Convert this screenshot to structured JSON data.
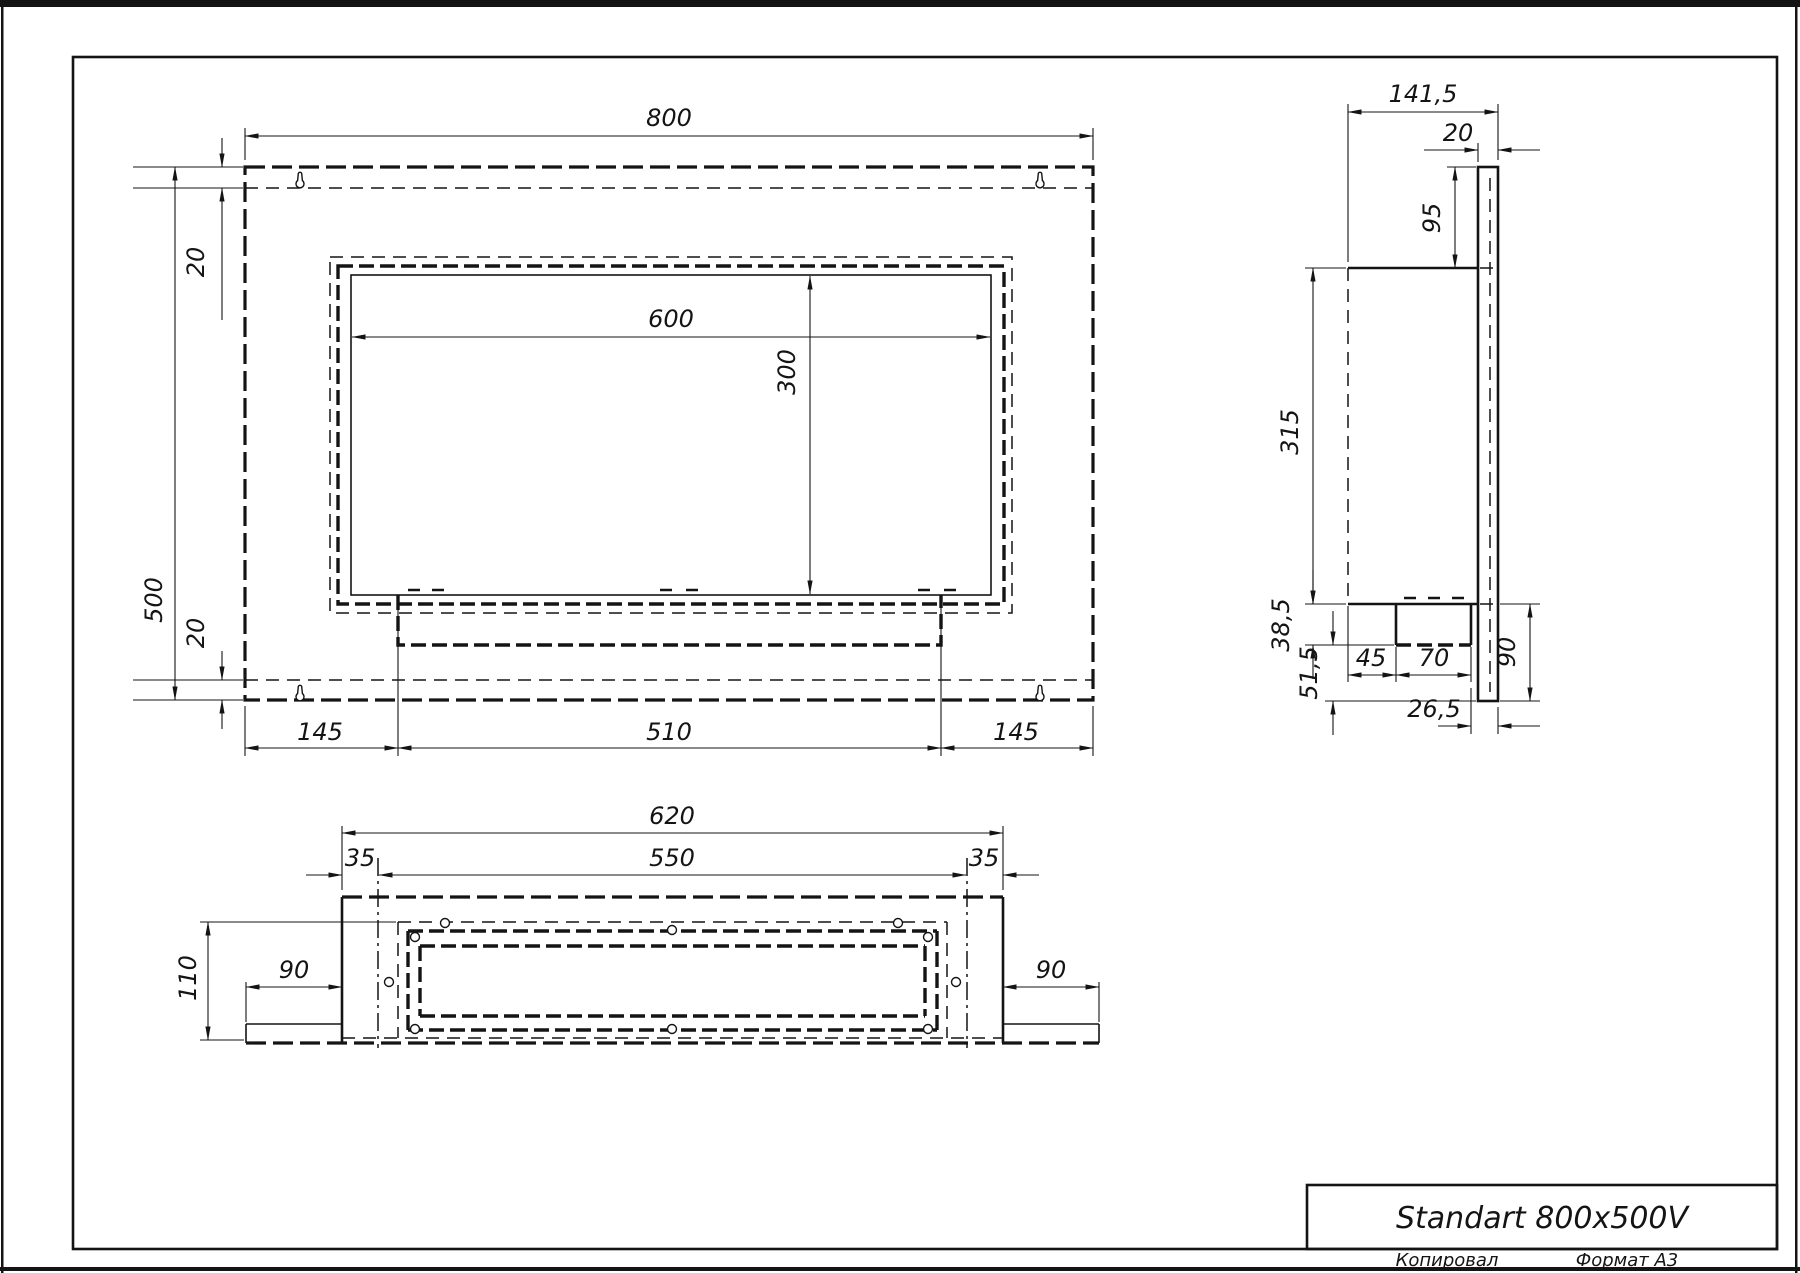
{
  "colors": {
    "ink": "#141414",
    "paper": "#ffffff"
  },
  "title_block": {
    "title": "Standart 800x500V",
    "footer_left": "Копировал",
    "footer_right": "Формат А3"
  },
  "front": {
    "width": "800",
    "height": "500",
    "top_offset": "20",
    "bottom_offset": "20",
    "opening_width": "600",
    "opening_height": "300",
    "margin_left": "145",
    "burner_width": "510",
    "margin_right": "145"
  },
  "side": {
    "depth": "141,5",
    "plate_thickness": "20",
    "top_to_body": "95",
    "body_height": "315",
    "tray_height": "38,5",
    "tray_to_bottom": "51,5",
    "tray_offset": "45",
    "tray_width": "70",
    "below_body": "90",
    "tray_to_plate": "26,5"
  },
  "bottom": {
    "box_width": "620",
    "inner_width": "550",
    "offset_left": "35",
    "offset_right": "35",
    "depth": "110",
    "wing_left": "90",
    "wing_right": "90"
  }
}
